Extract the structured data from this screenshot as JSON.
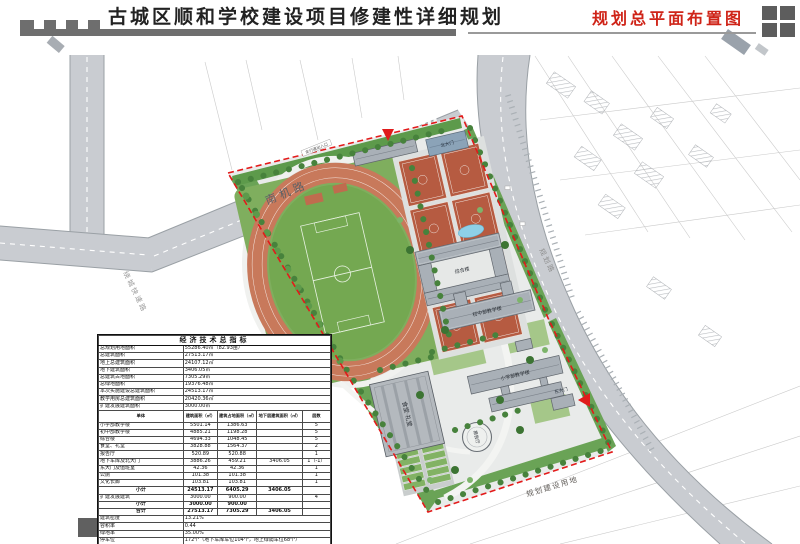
{
  "header": {
    "title_left": "古城区顺和学校建设项目修建性详细规划",
    "title_right": "规划总平面布置图"
  },
  "map": {
    "roads": {
      "south_airport_road": "南机路",
      "ring_road": "绕城快速路",
      "east_road": "规划路"
    },
    "area_label": "规划建设用地",
    "annotation": "车行道出入口",
    "buildings": {
      "north_gate": "北大门",
      "complex": "综合楼",
      "junior": "初中部教学楼",
      "primary": "小学部教学楼",
      "canteen": "食堂·礼堂",
      "hall": "报告厅",
      "east_gate": "东大门"
    }
  },
  "table": {
    "title": "经济技术总指标",
    "summary": [
      {
        "label": "总规划用地面积",
        "value": "55286.40㎡（82.93亩）"
      },
      {
        "label": "总建筑面积",
        "value": "27513.17㎡"
      },
      {
        "label": "地上总建筑面积",
        "value": "24107.12㎡"
      },
      {
        "label": "地下建筑面积",
        "value": "3406.05㎡"
      },
      {
        "label": "总建筑占地面积",
        "value": "7305.29㎡"
      },
      {
        "label": "总绿地面积",
        "value": "19376.48㎡"
      },
      {
        "label": "本次实施建设总建筑面积",
        "value": "24513.17㎡"
      },
      {
        "label": "教学用房总建筑面积",
        "value": "20420.36㎡"
      },
      {
        "label": "扩建发展建筑面积",
        "value": "3000.00㎡"
      }
    ],
    "columns": [
      "单体",
      "建筑面积（㎡）",
      "建筑占地面积（㎡）",
      "地下层建筑面积（㎡）",
      "层数"
    ],
    "buildings": [
      {
        "name": "小学部教学楼",
        "area": "5501.14",
        "footprint": "1386.63",
        "basement": "",
        "floors": "5"
      },
      {
        "name": "初中部教学楼",
        "area": "4885.21",
        "footprint": "1198.28",
        "basement": "",
        "floors": "5"
      },
      {
        "name": "综合楼",
        "area": "4694.33",
        "footprint": "1048.45",
        "basement": "",
        "floors": "5"
      },
      {
        "name": "食堂、礼堂",
        "area": "3828.88",
        "footprint": "1564.37",
        "basement": "",
        "floors": "2"
      },
      {
        "name": "报告厅",
        "area": "520.89",
        "footprint": "520.88",
        "basement": "",
        "floors": "1"
      },
      {
        "name": "地下车库及北大门",
        "area": "3886.26",
        "footprint": "459.21",
        "basement": "3406.05",
        "floors": "1（-1）"
      },
      {
        "name": "东大门及值班室",
        "area": "42.36",
        "footprint": "42.36",
        "basement": "",
        "floors": "1"
      },
      {
        "name": "公厕",
        "area": "101.38",
        "footprint": "101.38",
        "basement": "",
        "floors": "1"
      },
      {
        "name": "文化长廊",
        "area": "103.81",
        "footprint": "103.81",
        "basement": "",
        "floors": "1"
      }
    ],
    "subtotal1": {
      "name": "小计",
      "area": "24513.17",
      "footprint": "6405.29",
      "basement": "3406.05",
      "floors": ""
    },
    "expansion": {
      "name": "扩建发展建筑",
      "area": "3000.00",
      "footprint": "900.00",
      "basement": "",
      "floors": "4"
    },
    "subtotal2": {
      "name": "小计",
      "area": "3000.00",
      "footprint": "900.00",
      "basement": "",
      "floors": ""
    },
    "total": {
      "name": "合计",
      "area": "27513.17",
      "footprint": "7305.29",
      "basement": "3406.05",
      "floors": ""
    },
    "metrics": [
      {
        "label": "建筑密度",
        "value": "13.21%"
      },
      {
        "label": "容积率",
        "value": "0.44"
      },
      {
        "label": "绿地率",
        "value": "35.00%"
      },
      {
        "label": "停车位",
        "value": "172个（地下车库车位104个，地上绿荫车位68个）"
      },
      {
        "label": "拟设临时考试车位",
        "value": "80个"
      },
      {
        "label": "自行车位",
        "value": "172个（对外100个，对内72个）"
      }
    ]
  }
}
